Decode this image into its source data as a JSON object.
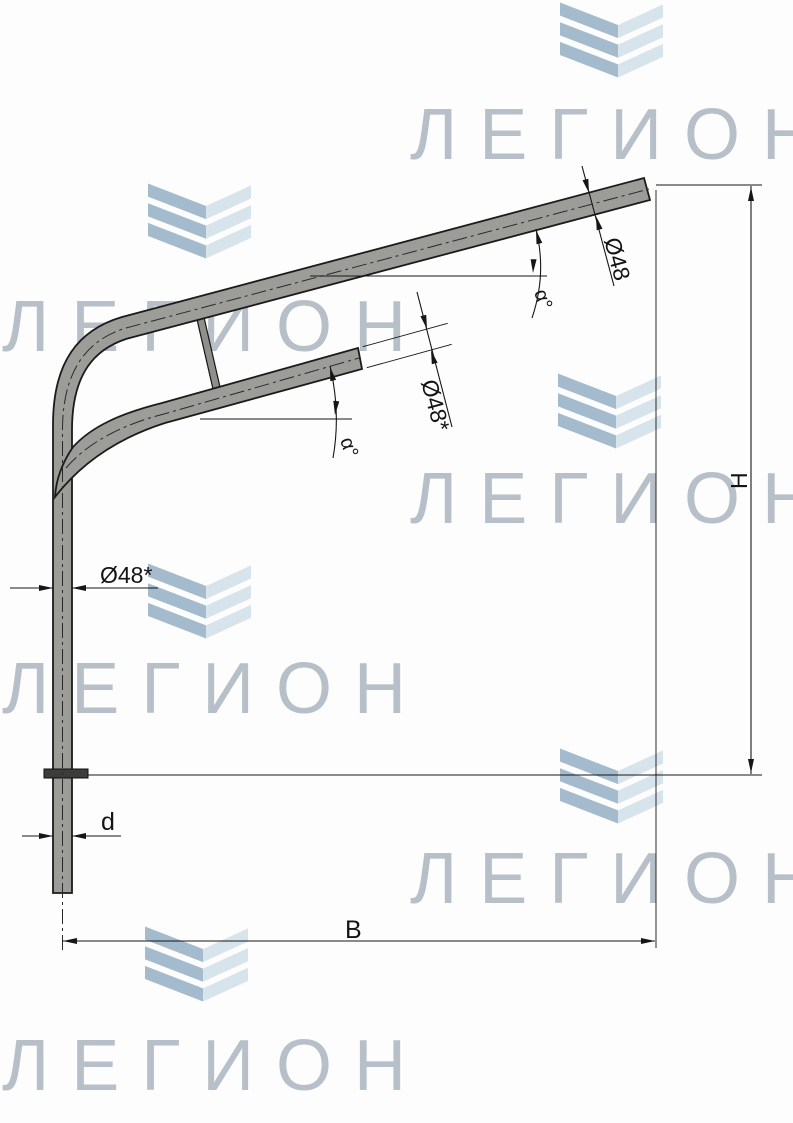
{
  "watermark": {
    "text": "ЛЕГИОН"
  },
  "colors": {
    "watermark_text": "#b7bfc8",
    "chevron_dark": "#a3bbcc",
    "chevron_light": "#d8e4ec",
    "pipe_fill": "#9c9c98",
    "outline": "#1b1b1b",
    "dim_line": "#161616"
  },
  "drawing": {
    "labels": {
      "upper_arm_diameter": "Ø48",
      "lower_arm_diameter": "Ø48*",
      "post_diameter": "Ø48*",
      "upper_arm_angle": "α°",
      "lower_arm_angle": "α°",
      "height": "H",
      "span": "B",
      "base_diameter": "d"
    }
  }
}
